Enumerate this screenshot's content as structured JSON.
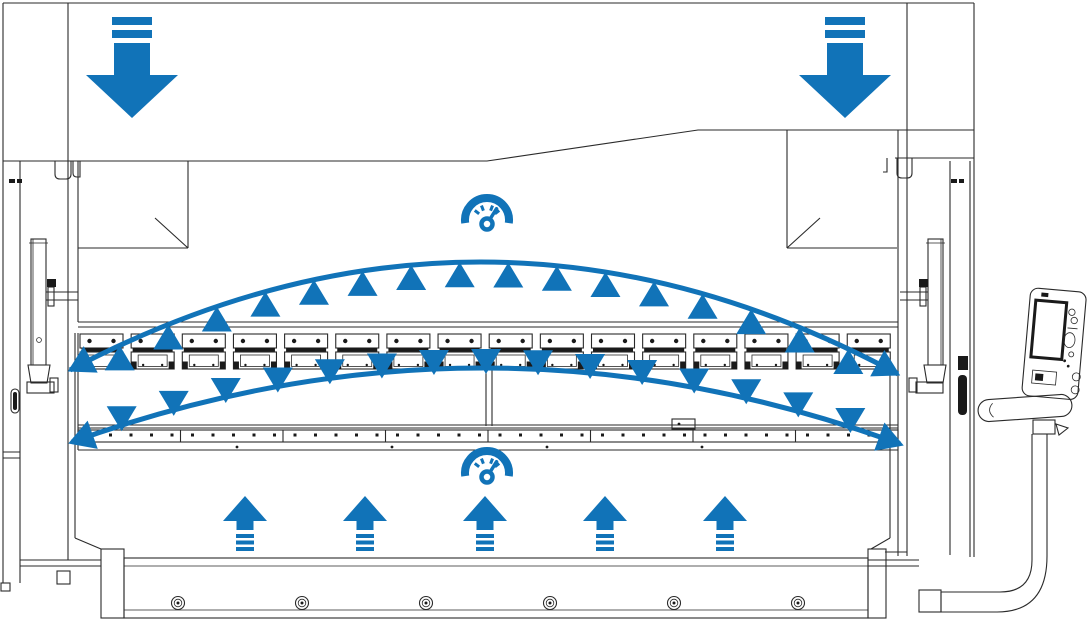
{
  "diagram_type": "press-brake crowning / deflection compensation schematic",
  "colors": {
    "accent_blue": "#1173b8",
    "line": "#2a2a2a",
    "line_dark": "#1a1a1a",
    "background": "#ffffff"
  },
  "annotations": {
    "down_force_arrows": [
      {
        "cx": 132,
        "top": 16
      },
      {
        "cx": 845,
        "top": 16
      }
    ],
    "up_force_arrows": {
      "centers": [
        245,
        365,
        485,
        605,
        725
      ],
      "tip_y": 496
    },
    "gauges": [
      {
        "cx": 487,
        "cy": 220
      },
      {
        "cx": 487,
        "cy": 473
      }
    ],
    "arcs": {
      "upper": {
        "p0": [
          70,
          370
        ],
        "c": [
          484,
          152
        ],
        "p1": [
          898,
          374
        ],
        "triangle_count": 16,
        "triangle_dir": "up"
      },
      "lower": {
        "p0": [
          72,
          442
        ],
        "c": [
          486,
          293
        ],
        "p1": [
          900,
          444
        ],
        "triangle_count": 15,
        "triangle_dir": "down"
      }
    }
  },
  "machine": {
    "clamps": {
      "count": 16,
      "x_start": 80,
      "pitch": 51.15,
      "width": 43,
      "y_top": 334
    },
    "table": {
      "segment_dividers": 7,
      "band": [
        78,
        430,
        820,
        12
      ],
      "dot_count": 40,
      "dot_start_x": 90,
      "dot_pitch": 20.5,
      "under_dots_x": [
        237,
        392,
        547,
        702
      ]
    },
    "base_bolts": {
      "xs": [
        178,
        302,
        426,
        550,
        674,
        798
      ],
      "y": 603
    }
  }
}
